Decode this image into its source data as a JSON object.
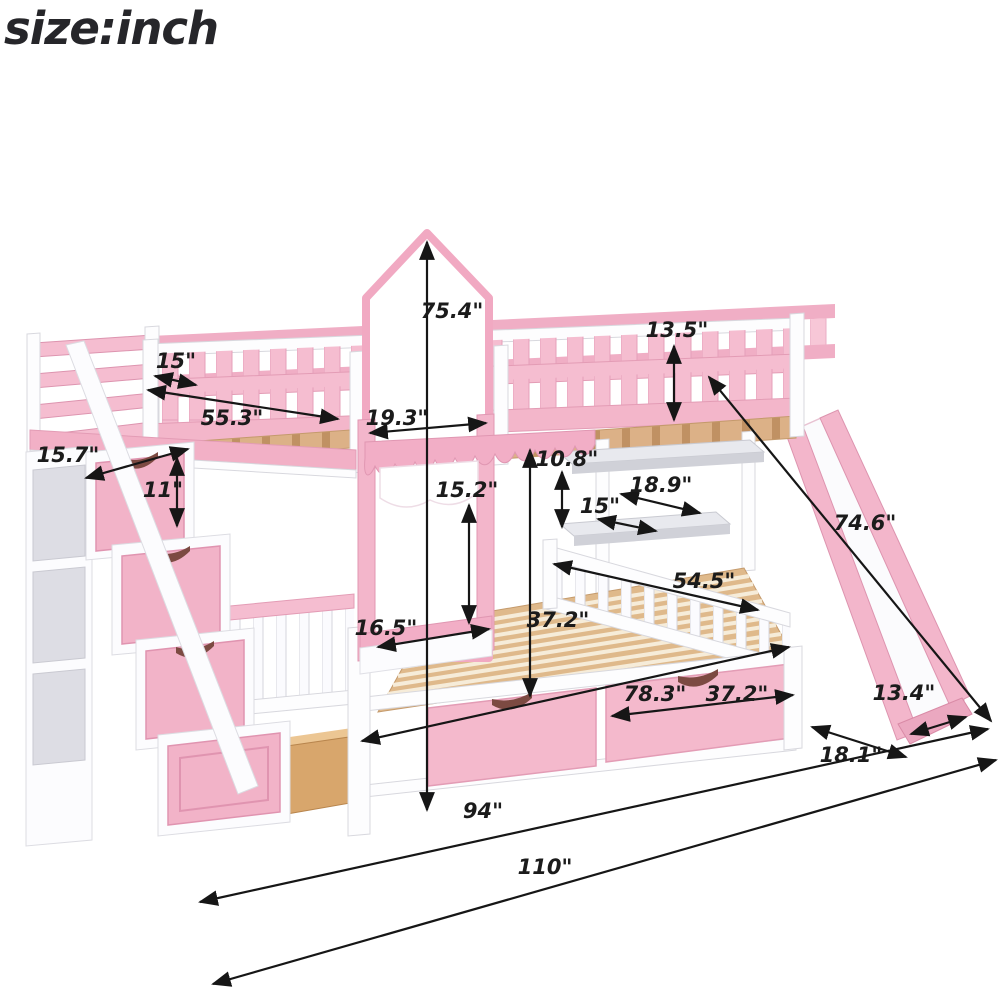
{
  "title": "size:inch",
  "product": "castle bunk bed with staircase drawers, storage shelves and slide",
  "colors": {
    "pink": "#f5bdd0",
    "pink_dark": "#e097b2",
    "white": "#ffffff",
    "wood": "#dcb187",
    "dimension_lines": "#161616"
  },
  "dimensions": {
    "total_height": "75.4\"",
    "guardrail_height": "13.5\"",
    "rail_gap": "15\"",
    "upper_guardrail_length": "55.3\"",
    "headboard_depth": "19.3\"",
    "stair_tread_depth": "15.7\"",
    "stair_riser_height": "11\"",
    "tower_panel_height": "15.2\"",
    "shelf_spacing": "10.8\"",
    "upper_shelf_depth": "18.9\"",
    "lower_shelf_depth": "15\"",
    "slide_length": "74.6\"",
    "bunk_clearance_height": "37.2\"",
    "lower_guardrail_length": "54.5\"",
    "ledge_width": "16.5\"",
    "bed_interior_length": "78.3\"",
    "drawer_width": "37.2\"",
    "slide_end_width": "13.4\"",
    "slide_floor_clearance": "18.1\"",
    "bed_frame_length": "94\"",
    "total_length": "110\""
  }
}
